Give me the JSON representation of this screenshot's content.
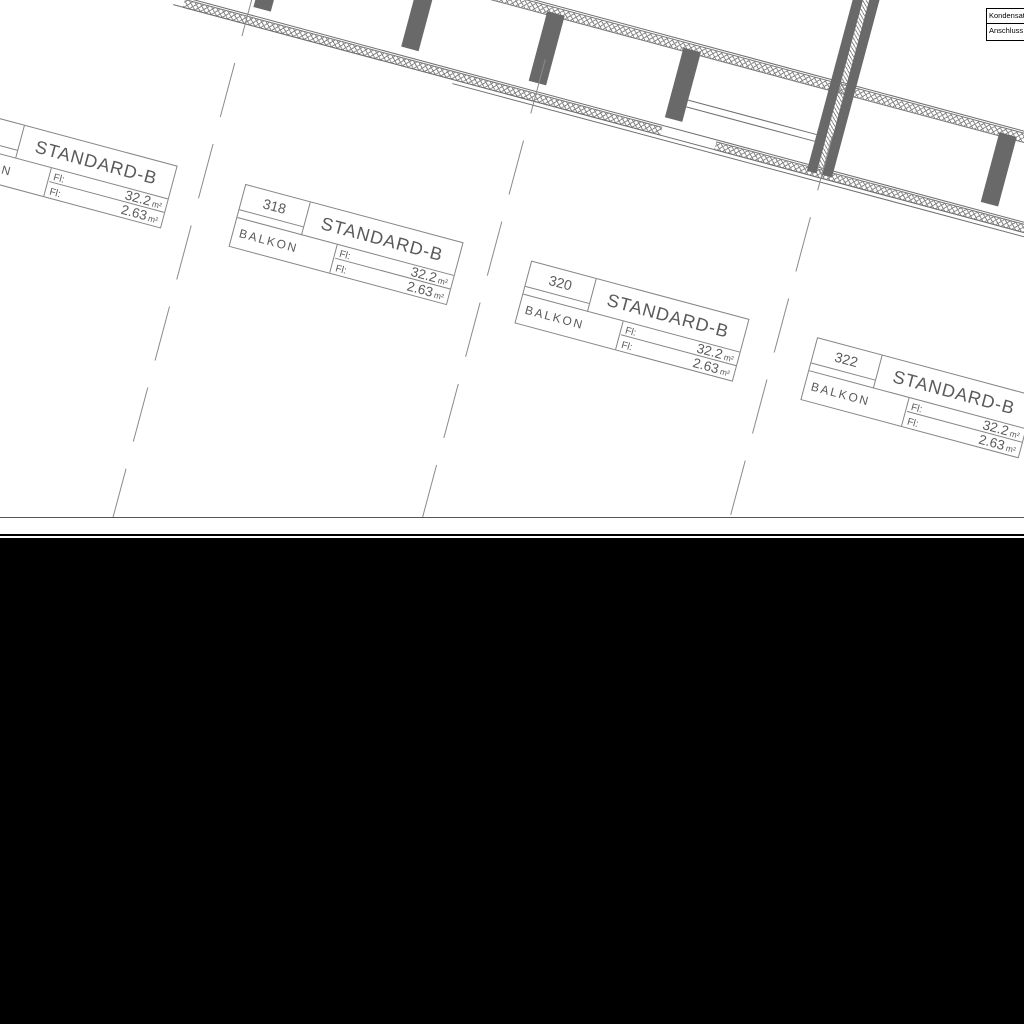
{
  "plan": {
    "rooms": [
      {
        "number": "316",
        "type": "STANDARD-B",
        "balcony_label": "BALKON",
        "rows": [
          {
            "label": "Fl:",
            "value": "32.2",
            "unit": "m²"
          },
          {
            "label": "Fl:",
            "value": "2.63",
            "unit": "m²"
          }
        ]
      },
      {
        "number": "318",
        "type": "STANDARD-B",
        "balcony_label": "BALKON",
        "rows": [
          {
            "label": "Fl:",
            "value": "32.2",
            "unit": "m²"
          },
          {
            "label": "Fl:",
            "value": "2.63",
            "unit": "m²"
          }
        ]
      },
      {
        "number": "320",
        "type": "STANDARD-B",
        "balcony_label": "BALKON",
        "rows": [
          {
            "label": "Fl:",
            "value": "32.2",
            "unit": "m²"
          },
          {
            "label": "Fl:",
            "value": "2.63",
            "unit": "m²"
          }
        ]
      },
      {
        "number": "322",
        "type": "STANDARD-B",
        "balcony_label": "BALKON",
        "rows": [
          {
            "label": "Fl:",
            "value": "32.2",
            "unit": "m²"
          },
          {
            "label": "Fl:",
            "value": "2.63",
            "unit": "m²"
          }
        ]
      }
    ],
    "corner_note": {
      "line1": "Kondensat",
      "line2": "Anschluss"
    }
  }
}
